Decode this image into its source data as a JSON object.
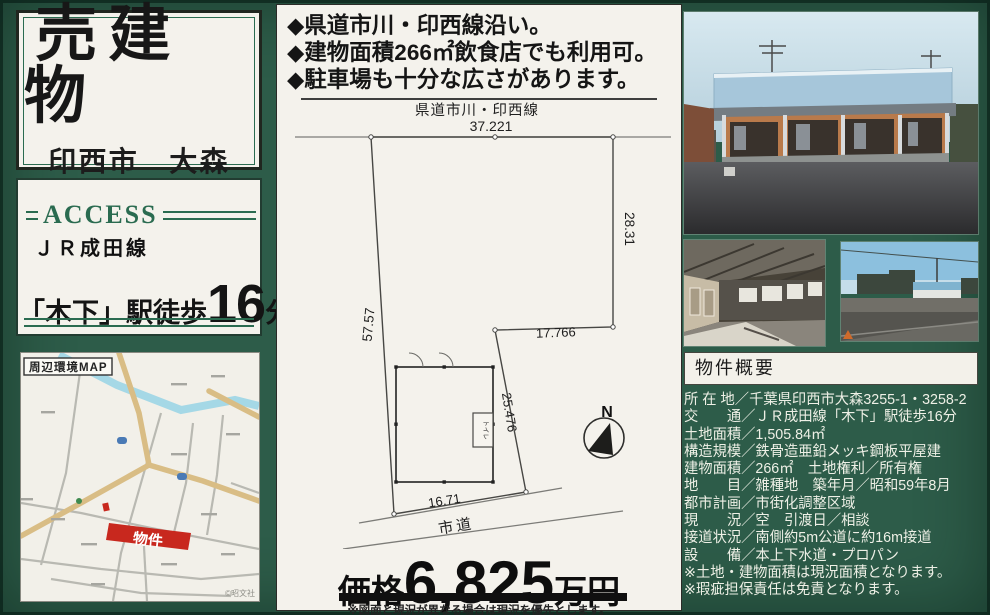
{
  "colors": {
    "background_green": "#2d5c49",
    "panel_offwhite": "#f4f2ec",
    "accent_green": "#2a6b50",
    "marker_red": "#c8281e",
    "text_black": "#151515"
  },
  "left": {
    "title_panel": {
      "title": "売建物",
      "subtitle": "印西市　大森"
    },
    "access_panel": {
      "heading": "ACCESS",
      "rail_line": "ＪＲ成田線",
      "walk_prefix": "「木下」駅徒歩",
      "walk_number": "16",
      "walk_suffix": "分"
    },
    "map_panel": {
      "label": "周辺環境MAP",
      "marker_label": "物件",
      "copyright": "©昭文社"
    }
  },
  "middle": {
    "bullets": [
      "◆県道市川・印西線沿い。",
      "◆建物面積266㎡飲食店でも利用可。",
      "◆駐車場も十分な広さがあります。"
    ],
    "site_plan": {
      "top_road_label": "県道市川・印西線",
      "bottom_road_label": "市道",
      "building_room_label": "トイレ",
      "compass_label": "N",
      "dims": {
        "top": "37.221",
        "right_upper": "28.31",
        "left": "57.57",
        "step": "17.766",
        "right_lower": "25.476",
        "bottom": "16.71"
      }
    },
    "price": {
      "label": "価格",
      "amount": "6,825",
      "unit": "万円"
    },
    "footnote": "※図面と現況が異なる場合は現況を優先とします。"
  },
  "right": {
    "summary": {
      "heading": "物件概要",
      "rows": [
        "所 在 地／千葉県印西市大森3255-1・3258-2",
        "交　　通／ＪＲ成田線「木下」駅徒歩16分",
        "土地面積／1,505.84㎡",
        "構造規模／鉄骨造亜鉛メッキ鋼板平屋建",
        "建物面積／266㎡　土地権利／所有権",
        "地　　目／雑種地　築年月／昭和59年8月",
        "都市計画／市街化調整区域",
        "現　　況／空　引渡日／相談",
        "接道状況／南側約5m公道に約16m接道",
        "設　　備／本上下水道・プロパン",
        "※土地・建物面積は現況面積となります。",
        "※瑕疵担保責任は免責となります。"
      ]
    }
  }
}
